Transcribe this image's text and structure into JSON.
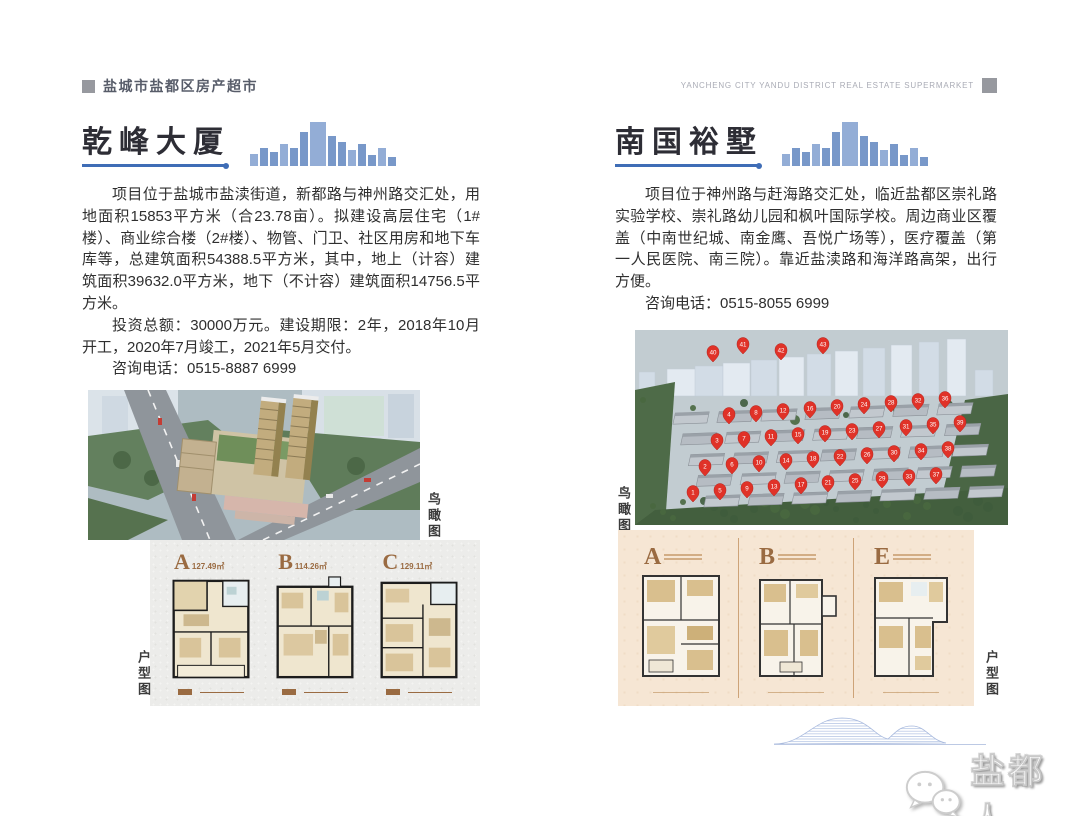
{
  "header": {
    "left_title": "盐城市盐都区房产超市",
    "right_title": "YANCHENG CITY YANDU DISTRICT REAL ESTATE SUPERMARKET"
  },
  "left_page": {
    "title": "乾峰大厦",
    "paragraph1": "项目位于盐城市盐渎街道，新都路与神州路交汇处，用地面积15853平方米（合23.78亩）。拟建设高层住宅（1#楼）、商业综合楼（2#楼）、物管、门卫、社区用房和地下车库等，总建筑面积54388.5平方米，其中，地上（计容）建筑面积39632.0平方米，地下（不计容）建筑面积14756.5平方米。",
    "paragraph2": "投资总额：30000万元。建设期限：2年，2018年10月开工，2020年7月竣工，2021年5月交付。",
    "phone_line": "咨询电话：0515-8887 6999",
    "aerial_label": "鸟瞰图",
    "floorplan_label": "户型图",
    "floorplans": [
      {
        "letter": "A",
        "area": "127.49㎡"
      },
      {
        "letter": "B",
        "area": "114.26㎡"
      },
      {
        "letter": "C",
        "area": "129.11㎡"
      }
    ]
  },
  "right_page": {
    "title": "南国裕墅",
    "paragraph1": "项目位于神州路与赶海路交汇处，临近盐都区崇礼路实验学校、崇礼路幼儿园和枫叶国际学校。周边商业区覆盖（中南世纪城、南金鹰、吾悦广场等），医疗覆盖（第一人民医院、南三院）。靠近盐渎路和海洋路高架，出行方便。",
    "phone_line": "咨询电话：0515-8055 6999",
    "aerial_label": "鸟瞰图",
    "floorplan_label": "户型图",
    "floorplans": [
      {
        "letter": "A"
      },
      {
        "letter": "B"
      },
      {
        "letter": "E"
      }
    ],
    "site_pins": [
      1,
      2,
      3,
      4,
      5,
      6,
      7,
      8,
      9,
      10,
      11,
      12,
      13,
      14,
      15,
      16,
      17,
      18,
      19,
      20,
      21,
      22,
      23,
      24,
      25,
      26,
      27,
      28,
      29,
      30,
      31,
      32,
      33,
      34,
      35,
      36,
      37,
      38,
      39,
      40,
      41,
      42,
      43
    ]
  },
  "footer": {
    "brand": "盐都人"
  },
  "colors": {
    "accent_blue": "#3f6db6",
    "skyline_blue": "#6d8fc4",
    "plan_brown": "#9a6b42",
    "pin_red": "#e03228",
    "header_gray": "#97999f"
  }
}
